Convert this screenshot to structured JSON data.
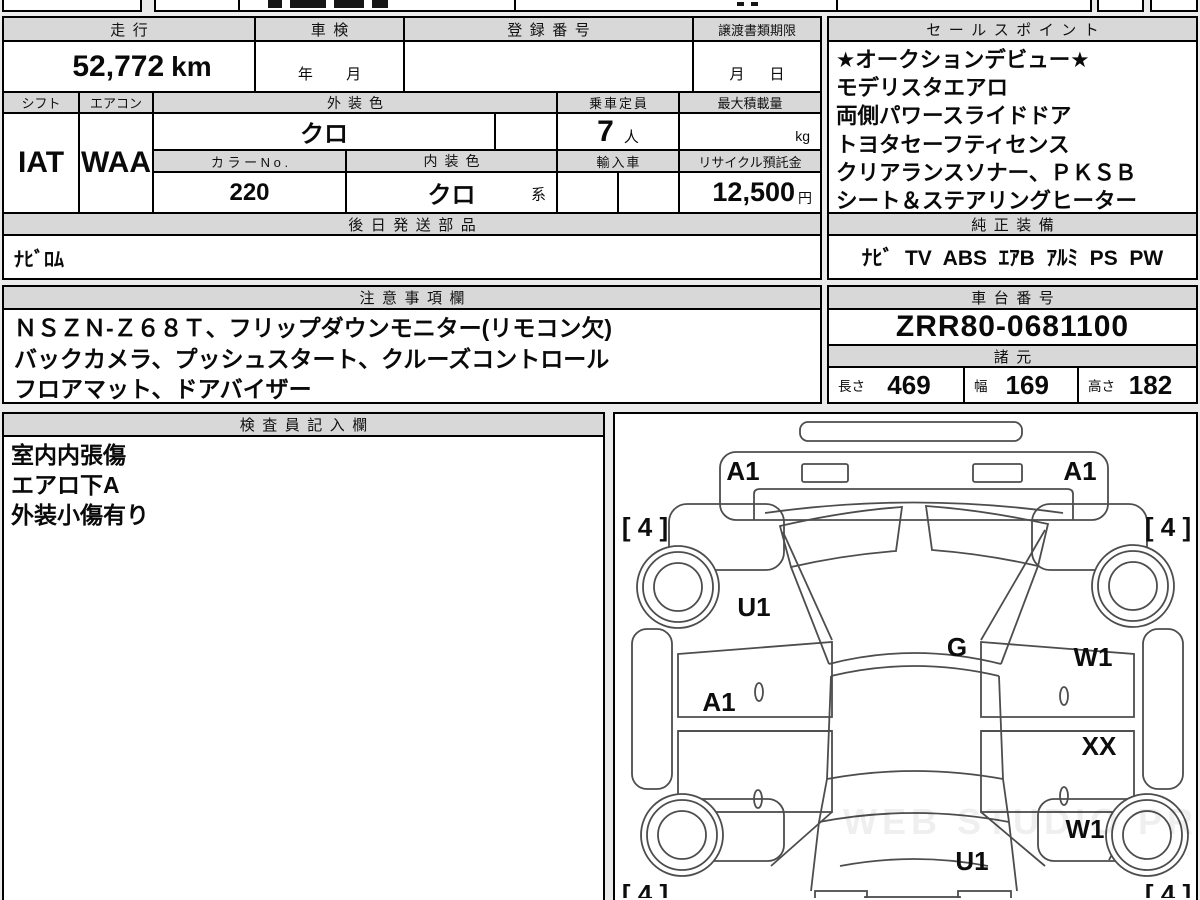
{
  "doc": {
    "mileage": {
      "label": "走行",
      "value": "52,772",
      "unit": "km"
    },
    "shaken": {
      "label": "車検",
      "placeholder": "年        月"
    },
    "registration": {
      "label": "登録番号"
    },
    "deadline": {
      "label": "譲渡書類期限",
      "placeholder": "月      日"
    },
    "shift": {
      "label": "シフト",
      "value": "IAT"
    },
    "aircon": {
      "label": "エアコン",
      "value": "WAA"
    },
    "exterior_color": {
      "label": "外装色",
      "value": "クロ"
    },
    "capacity": {
      "label": "乗車定員",
      "value": "7",
      "unit": "人"
    },
    "max_load": {
      "label": "最大積載量",
      "unit": "kg"
    },
    "color_no": {
      "label": "カ ラ ー N o .",
      "value": "220"
    },
    "interior_color": {
      "label": "内装色",
      "value": "クロ",
      "suffix": "系"
    },
    "import_car": {
      "label": "輸入車"
    },
    "recycle": {
      "label": "リサイクル預託金",
      "value": "12,500",
      "unit": "円"
    },
    "later_parts": {
      "label": "後日発送部品",
      "value": "ﾅﾋﾞﾛﾑ"
    },
    "sales_points": {
      "title": "セールスポイント",
      "lines": [
        "★オークションデビュー★",
        "モデリスタエアロ",
        "両側パワースライドドア",
        "トヨタセーフティセンス",
        "クリアランスソナー、ＰＫＳＢ",
        "シート＆ステアリングヒーター"
      ]
    },
    "equipment": {
      "title": "純正装備",
      "items": [
        "ﾅﾋﾞ",
        "TV",
        "ABS",
        "ｴｱB",
        "ｱﾙﾐ",
        "PS",
        "PW"
      ]
    },
    "notes": {
      "title": "注意事項欄",
      "lines": [
        "ＮＳＺＮ-Ｚ６８Ｔ、フリップダウンモニター(リモコン欠)",
        "バックカメラ、プッシュスタート、クルーズコントロール",
        "フロアマット、ドアバイザー"
      ]
    },
    "chassis": {
      "title": "車台番号",
      "value": "ZRR80-0681100"
    },
    "specs": {
      "title": "諸元",
      "length_label": "長さ",
      "length": "469",
      "width_label": "幅",
      "width": "169",
      "height_label": "高さ",
      "height": "182"
    },
    "inspector": {
      "title": "検査員記入欄",
      "lines": [
        "室内内張傷",
        "エアロ下A",
        "外装小傷有り"
      ]
    }
  },
  "diagram": {
    "watermark": "WEB STUDIO PRO",
    "labels": [
      {
        "text": "A1",
        "x": 128,
        "y": 66
      },
      {
        "text": "A1",
        "x": 465,
        "y": 66
      },
      {
        "text": "[ 4 ]",
        "x": 30,
        "y": 122
      },
      {
        "text": "[ 4 ]",
        "x": 553,
        "y": 122
      },
      {
        "text": "U1",
        "x": 139,
        "y": 202
      },
      {
        "text": "G",
        "x": 342,
        "y": 242
      },
      {
        "text": "W1",
        "x": 478,
        "y": 252
      },
      {
        "text": "A1",
        "x": 104,
        "y": 297
      },
      {
        "text": "XX",
        "x": 484,
        "y": 341
      },
      {
        "text": "W1",
        "x": 470,
        "y": 424
      },
      {
        "text": "U1",
        "x": 357,
        "y": 456
      },
      {
        "text": "[ 4 ]",
        "x": 30,
        "y": 489
      },
      {
        "text": "[ 4 ]",
        "x": 553,
        "y": 489
      }
    ]
  }
}
